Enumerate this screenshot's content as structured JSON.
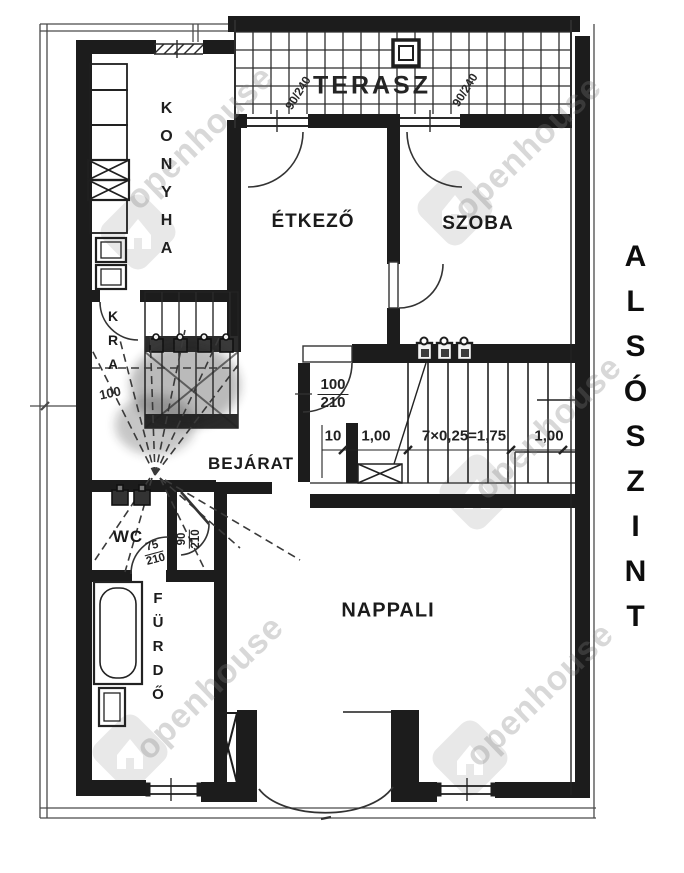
{
  "plan": {
    "side_title": "ALSÓSZINT",
    "rooms": {
      "terasz": "TERASZ",
      "konyha": "KONYHA",
      "kamra_partial": "KRA",
      "etkezo": "ÉTKEZŐ",
      "szoba": "SZOBA",
      "bejarat": "BEJÁRAT",
      "wc": "WC",
      "furdo": "FÜRDŐ",
      "nappali": "NAPPALI"
    },
    "dimensions": {
      "terasz_door_left": "90/240",
      "terasz_door_right": "90/240",
      "hall_door_w": "100",
      "hall_door_h": "210",
      "kamra_width": "100",
      "stair_left_offset": "10",
      "stair_landing": "1,00",
      "stair_formula": "7×0,25=1,75",
      "stair_right": "1,00",
      "wc_door_w": "75",
      "wc_door_h": "210",
      "vestibule_door_w": "90",
      "vestibule_door_h": "210"
    },
    "watermark": {
      "text": "openhouse"
    },
    "colors": {
      "ink": "#1c1c1c",
      "watermark_gray": "#8a8a8a"
    }
  }
}
